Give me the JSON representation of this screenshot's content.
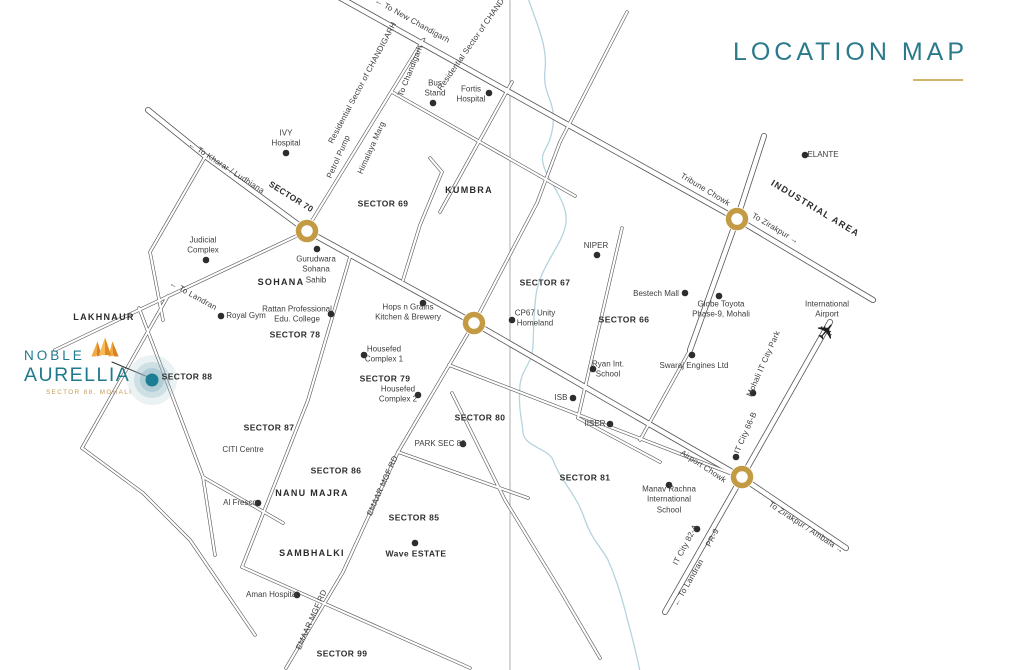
{
  "title": {
    "text": "LOCATION MAP"
  },
  "logo": {
    "name_line1": "NOBLE",
    "name_line2": "AURELLIA",
    "subtitle": "SECTOR 88, MOHALI"
  },
  "map": {
    "colors": {
      "road_casing": "#565656",
      "road_fill": "#ffffff",
      "river": "#b5d4dd",
      "fold_line": "#9a9a9a",
      "roundabout_gold": "#c49b45",
      "dot": "#2d2d2d",
      "target_teal": "#1b7e93",
      "target_halo": "#8fb6c4",
      "accent_gold": "#d3b269",
      "brand_teal": "#1e7a8c"
    },
    "geometry": {
      "highways": [
        "M148,110 L205,156 L307,231 L474,323 L741,477 L846,548",
        "M337,-4 L737,219 L873,300",
        "M830,322 L742,477 L665,612",
        "M764,136 L737,219 L690,350"
      ],
      "roads": [
        "M423,40 L305,232",
        "M307,231 L122,318 L55,350",
        "M205,157 L150,252 L163,320",
        "M392,92 L575,196",
        "M512,82 L440,212",
        "M430,158 L442,172 L420,225 L403,280",
        "M627,12 L560,142 L537,203 L474,323",
        "M474,323 L398,452 L343,572 L286,668",
        "M622,228 L578,418",
        "M690,350 L640,440",
        "M449,365 L740,477",
        "M578,418 L660,462",
        "M168,296 L82,448",
        "M82,448 L143,493 L190,540 L255,635",
        "M139,308 L203,477 L215,555",
        "M350,257 L308,400 L242,567",
        "M242,567 L470,668",
        "M452,393 L505,500 L560,590 L600,658",
        "M398,452 L528,498",
        "M203,477 L283,523"
      ],
      "river": "M527,-5 C535,20 548,45 545,70 C542,95 556,100 553,125 C550,150 540,150 543,163 C546,180 568,200 566,222 C564,244 540,265 536,295 C533,320 534,330 533,345 C532,365 522,368 520,385 C518,408 522,420 523,432 C524,447 548,448 553,460 C558,472 560,475 566,484 C575,498 580,505 585,520 C592,540 602,548 608,560 C616,578 620,592 625,610 C630,630 636,650 640,672",
      "fold_line": "M510,0 L510,670",
      "pointer_line": "M112,362 L148,377"
    },
    "roundabouts": [
      {
        "x": 307,
        "y": 231
      },
      {
        "x": 474,
        "y": 323
      },
      {
        "x": 737,
        "y": 219
      },
      {
        "x": 742,
        "y": 477
      }
    ],
    "target": {
      "x": 152,
      "y": 380
    },
    "airplane": {
      "x": 827,
      "y": 332,
      "rotate": -50
    },
    "dots": [
      [
        286,
        153
      ],
      [
        206,
        260
      ],
      [
        433,
        103
      ],
      [
        489,
        93
      ],
      [
        317,
        249
      ],
      [
        221,
        316
      ],
      [
        331,
        314
      ],
      [
        423,
        303
      ],
      [
        364,
        355
      ],
      [
        418,
        395
      ],
      [
        463,
        444
      ],
      [
        512,
        320
      ],
      [
        597,
        255
      ],
      [
        685,
        293
      ],
      [
        719,
        296
      ],
      [
        805,
        155
      ],
      [
        593,
        369
      ],
      [
        692,
        355
      ],
      [
        573,
        398
      ],
      [
        610,
        424
      ],
      [
        669,
        485
      ],
      [
        753,
        393
      ],
      [
        736,
        457
      ],
      [
        697,
        529
      ],
      [
        258,
        503
      ],
      [
        297,
        595
      ],
      [
        415,
        543
      ]
    ],
    "labels": [
      {
        "t": "← To New Chandigarh",
        "x": 412,
        "y": 21,
        "c": "r",
        "r": 29
      },
      {
        "t": "Residential Sector of\nCHANDIGARH",
        "x": 363,
        "y": 83,
        "c": "r",
        "r": -62
      },
      {
        "t": "Residential Sector of\nCHANDIGARH",
        "x": 479,
        "y": 34,
        "c": "r",
        "r": -55
      },
      {
        "t": "To Chandigarh →",
        "x": 413,
        "y": 66,
        "c": "r",
        "r": -68
      },
      {
        "t": "Bus\nStand",
        "x": 435,
        "y": 89,
        "c": "p"
      },
      {
        "t": "Fortis\nHospital",
        "x": 471,
        "y": 95,
        "c": "p"
      },
      {
        "t": "IVY\nHospital",
        "x": 286,
        "y": 139,
        "c": "p"
      },
      {
        "t": "Petrol Pump",
        "x": 339,
        "y": 157,
        "c": "r",
        "r": -66
      },
      {
        "t": "Himalaya Marg",
        "x": 372,
        "y": 148,
        "c": "r",
        "r": -66
      },
      {
        "t": "← To Kharar / Ludhiana",
        "x": 226,
        "y": 168,
        "c": "r",
        "r": 33
      },
      {
        "t": "SECTOR 70",
        "x": 291,
        "y": 197,
        "c": "s",
        "r": 32
      },
      {
        "t": "SECTOR 69",
        "x": 383,
        "y": 204,
        "c": "s"
      },
      {
        "t": "KUMBRA",
        "x": 469,
        "y": 191,
        "c": "a"
      },
      {
        "t": "Judicial\nComplex",
        "x": 203,
        "y": 246,
        "c": "p"
      },
      {
        "t": "Gurudwara\nSohana\nSahib",
        "x": 316,
        "y": 270,
        "c": "p"
      },
      {
        "t": "SOHANA",
        "x": 281,
        "y": 283,
        "c": "a"
      },
      {
        "t": "← To Landran",
        "x": 193,
        "y": 296,
        "c": "r",
        "r": 29
      },
      {
        "t": "Royal Gym",
        "x": 246,
        "y": 316,
        "c": "p"
      },
      {
        "t": "Rattan Professional\nEdu. College",
        "x": 297,
        "y": 315,
        "c": "p"
      },
      {
        "t": "SECTOR 78",
        "x": 295,
        "y": 335,
        "c": "s"
      },
      {
        "t": "Hops n Grains\nKitchen & Brewery",
        "x": 408,
        "y": 313,
        "c": "p"
      },
      {
        "t": "NIPER",
        "x": 596,
        "y": 246,
        "c": "p"
      },
      {
        "t": "SECTOR 67",
        "x": 545,
        "y": 283,
        "c": "s"
      },
      {
        "t": "CP67 Unity\nHomeland",
        "x": 535,
        "y": 319,
        "c": "p"
      },
      {
        "t": "Bestech Mall",
        "x": 656,
        "y": 294,
        "c": "p"
      },
      {
        "t": "SECTOR 66",
        "x": 624,
        "y": 320,
        "c": "s"
      },
      {
        "t": "Globe Toyota\nPhase-9, Mohali",
        "x": 721,
        "y": 310,
        "c": "p"
      },
      {
        "t": "ELANTE",
        "x": 823,
        "y": 155,
        "c": "p"
      },
      {
        "t": "Tribune Chowk",
        "x": 705,
        "y": 190,
        "c": "r",
        "r": 31
      },
      {
        "t": "INDUSTRIAL AREA",
        "x": 815,
        "y": 209,
        "c": "a",
        "r": 31
      },
      {
        "t": "To Zirakpur →",
        "x": 775,
        "y": 229,
        "c": "r",
        "r": 31
      },
      {
        "t": "International\nAirport",
        "x": 827,
        "y": 310,
        "c": "p"
      },
      {
        "t": "Ryan Int.\nSchool",
        "x": 608,
        "y": 370,
        "c": "p"
      },
      {
        "t": "Swaraj Engines Ltd",
        "x": 694,
        "y": 366,
        "c": "p"
      },
      {
        "t": "Mohali IT City Park",
        "x": 764,
        "y": 364,
        "c": "r",
        "r": -66
      },
      {
        "t": "ISB",
        "x": 561,
        "y": 398,
        "c": "p"
      },
      {
        "t": "IISER",
        "x": 595,
        "y": 424,
        "c": "p"
      },
      {
        "t": "SECTOR 81",
        "x": 585,
        "y": 478,
        "c": "s"
      },
      {
        "t": "Airport Chowk",
        "x": 703,
        "y": 467,
        "c": "r",
        "r": 33
      },
      {
        "t": "IT City 66-B",
        "x": 746,
        "y": 433,
        "c": "r",
        "r": -66
      },
      {
        "t": "Manav Rachna\nInternational\nSchool",
        "x": 669,
        "y": 500,
        "c": "p"
      },
      {
        "t": "IT City 82-A",
        "x": 686,
        "y": 545,
        "c": "r",
        "r": -62
      },
      {
        "t": "PR-9",
        "x": 713,
        "y": 538,
        "c": "r",
        "r": -62
      },
      {
        "t": "← To Landran",
        "x": 689,
        "y": 583,
        "c": "r",
        "r": -60
      },
      {
        "t": "To Zirakpur / Ambala →",
        "x": 806,
        "y": 528,
        "c": "r",
        "r": 33
      },
      {
        "t": "LAKHNAUR",
        "x": 104,
        "y": 318,
        "c": "a"
      },
      {
        "t": "SECTOR 88",
        "x": 187,
        "y": 377,
        "c": "s"
      },
      {
        "t": "SECTOR 87",
        "x": 269,
        "y": 428,
        "c": "s"
      },
      {
        "t": "CITI Centre",
        "x": 243,
        "y": 450,
        "c": "p"
      },
      {
        "t": "Al Fresco",
        "x": 240,
        "y": 503,
        "c": "p"
      },
      {
        "t": "SECTOR 86",
        "x": 336,
        "y": 471,
        "c": "s"
      },
      {
        "t": "NANU MAJRA",
        "x": 312,
        "y": 494,
        "c": "a"
      },
      {
        "t": "EMAAR MGF RD",
        "x": 383,
        "y": 486,
        "c": "r",
        "r": -66
      },
      {
        "t": "EMAAR MGF RD",
        "x": 312,
        "y": 620,
        "c": "r",
        "r": -66
      },
      {
        "t": "PARK SEC 80",
        "x": 440,
        "y": 444,
        "c": "p"
      },
      {
        "t": "SECTOR 80",
        "x": 480,
        "y": 418,
        "c": "s"
      },
      {
        "t": "SECTOR 79",
        "x": 385,
        "y": 379,
        "c": "s"
      },
      {
        "t": "Housefed\nComplex 1",
        "x": 384,
        "y": 355,
        "c": "p"
      },
      {
        "t": "Housefed\nComplex 2",
        "x": 398,
        "y": 395,
        "c": "p"
      },
      {
        "t": "SECTOR 85",
        "x": 414,
        "y": 518,
        "c": "s"
      },
      {
        "t": "Wave ESTATE",
        "x": 416,
        "y": 554,
        "c": "s"
      },
      {
        "t": "SAMBHALKI",
        "x": 312,
        "y": 554,
        "c": "a"
      },
      {
        "t": "Aman Hospital",
        "x": 272,
        "y": 595,
        "c": "p"
      },
      {
        "t": "SECTOR 99",
        "x": 342,
        "y": 654,
        "c": "s"
      }
    ]
  }
}
